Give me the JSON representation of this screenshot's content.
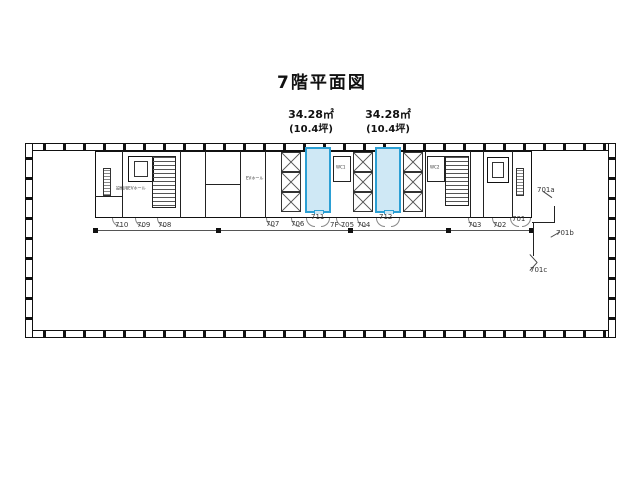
{
  "title": "7階平面図",
  "area_labels": [
    {
      "m2": "34.28㎡",
      "tsubo": "(10.4坪)"
    },
    {
      "m2": "34.28㎡",
      "tsubo": "(10.4坪)"
    }
  ],
  "room_numbers": {
    "r710": "710",
    "r709": "709",
    "r708": "708",
    "r707": "707",
    "r706": "706",
    "r711": "711",
    "r705": "7F 705",
    "r704": "704",
    "r712": "712",
    "r703": "703",
    "r702": "702",
    "r701": "701",
    "r701a": "701a",
    "r701b": "701b",
    "r701c": "701c"
  },
  "core_labels": {
    "service_ev": "設備用EVホール",
    "ev_hall": "EVホール",
    "wc1": "WC1",
    "wc2": "WC2"
  },
  "colors": {
    "highlight_fill": "#CFE8F5",
    "highlight_border": "#2B9FD4",
    "line": "#1a1a1a"
  }
}
